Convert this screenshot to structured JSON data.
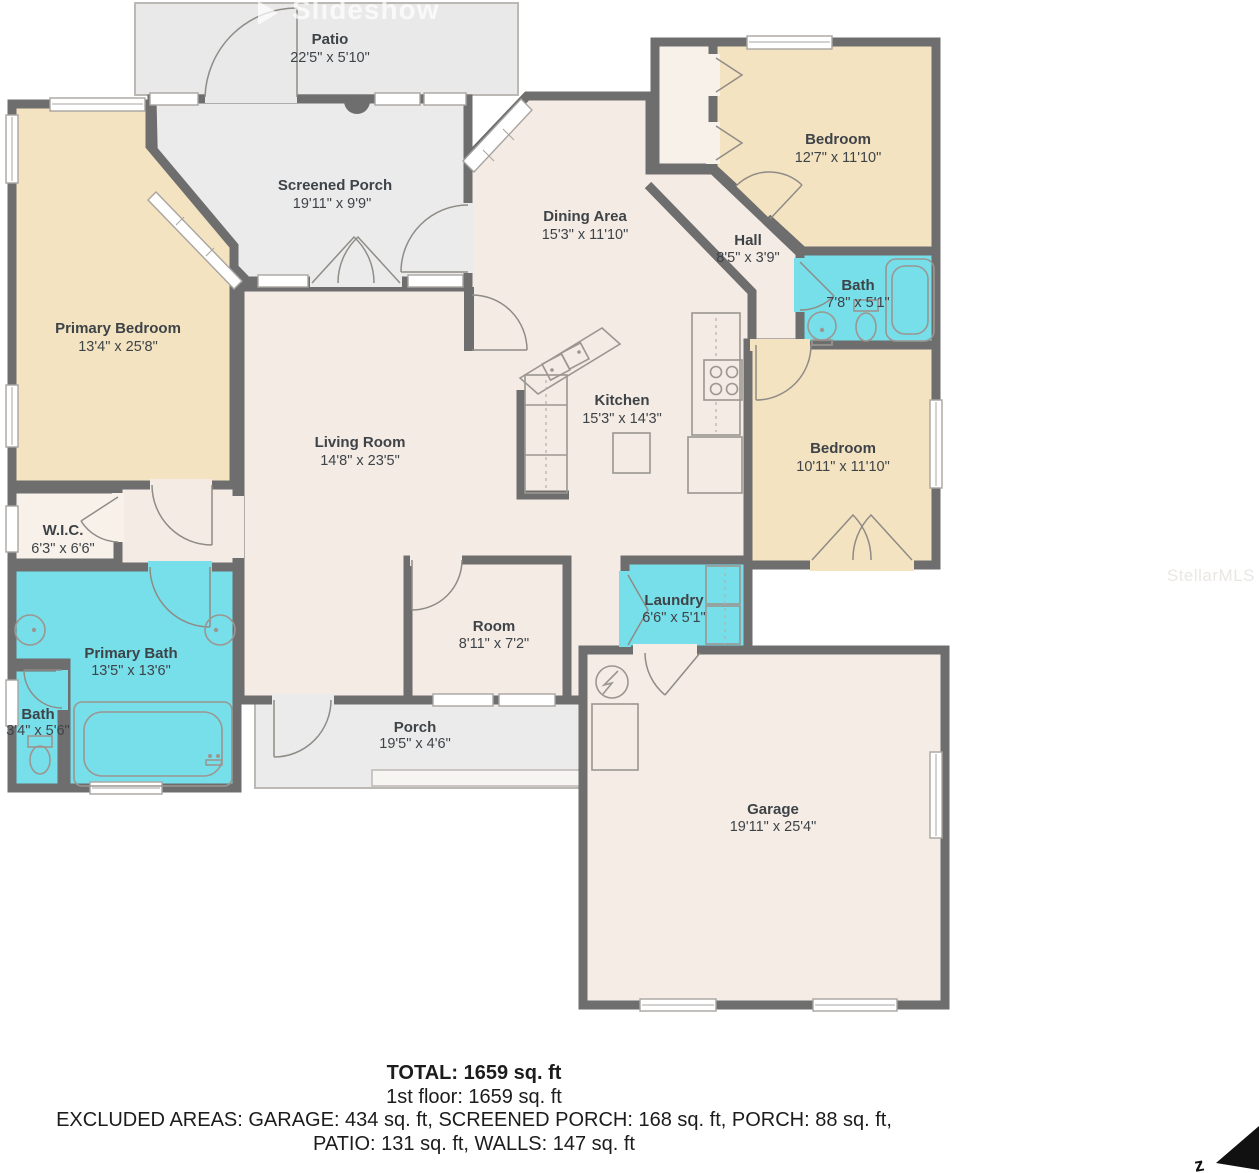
{
  "slideshow": {
    "label": "Slideshow"
  },
  "watermark": "StellarMLS",
  "compass": {
    "label": "z"
  },
  "rooms": {
    "patio": {
      "name": "Patio",
      "dims": "22'5\" x 5'10\""
    },
    "screened_porch": {
      "name": "Screened Porch",
      "dims": "19'11\" x 9'9\""
    },
    "dining": {
      "name": "Dining Area",
      "dims": "15'3\" x 11'10\""
    },
    "bedroom_top": {
      "name": "Bedroom",
      "dims": "12'7\" x 11'10\""
    },
    "hall": {
      "name": "Hall",
      "dims": "8'5\" x 3'9\""
    },
    "bath_top": {
      "name": "Bath",
      "dims": "7'8\" x 5'1\""
    },
    "primary_bedroom": {
      "name": "Primary Bedroom",
      "dims": "13'4\" x 25'8\""
    },
    "living": {
      "name": "Living Room",
      "dims": "14'8\" x 23'5\""
    },
    "kitchen": {
      "name": "Kitchen",
      "dims": "15'3\" x 14'3\""
    },
    "bedroom_right": {
      "name": "Bedroom",
      "dims": "10'11\" x 11'10\""
    },
    "wic": {
      "name": "W.I.C.",
      "dims": "6'3\" x 6'6\""
    },
    "primary_bath": {
      "name": "Primary Bath",
      "dims": "13'5\" x 13'6\""
    },
    "bath_small": {
      "name": "Bath",
      "dims": "3'4\" x 5'6\""
    },
    "room": {
      "name": "Room",
      "dims": "8'11\" x 7'2\""
    },
    "laundry": {
      "name": "Laundry",
      "dims": "6'6\" x 5'1\""
    },
    "porch": {
      "name": "Porch",
      "dims": "19'5\" x 4'6\""
    },
    "garage": {
      "name": "Garage",
      "dims": "19'11\" x 25'4\""
    }
  },
  "summary": {
    "total": "TOTAL: 1659 sq. ft",
    "floor1": "1st floor: 1659 sq. ft",
    "excluded_line1": "EXCLUDED AREAS: GARAGE: 434 sq. ft, SCREENED PORCH: 168 sq. ft, PORCH: 88 sq. ft,",
    "excluded_line2": "PATIO: 131 sq. ft, WALLS: 147 sq. ft"
  },
  "colors": {
    "wall": "#6e6e6e",
    "floor": "#f4ebe4",
    "bedroom": "#f4e3c1",
    "bath": "#77dfe9",
    "porch": "#ebebeb",
    "closet": "#f7f1ea",
    "garage": "#f4ece5"
  }
}
